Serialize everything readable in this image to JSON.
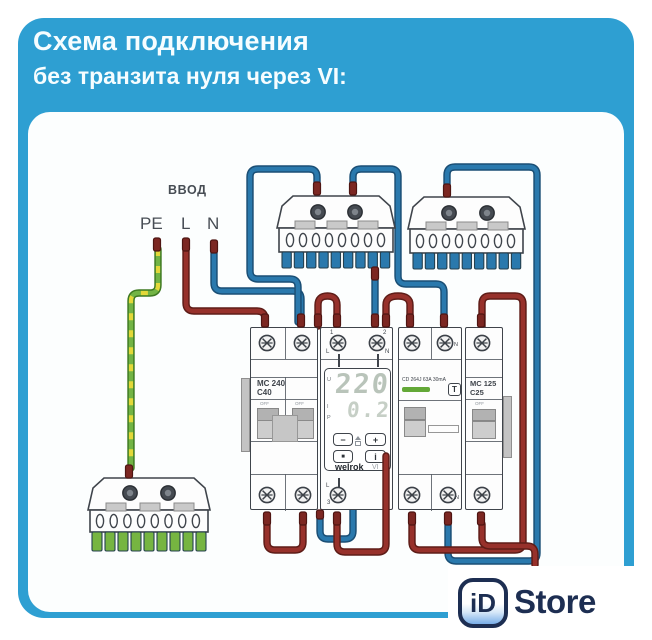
{
  "header": {
    "line1": "Схема подключения",
    "line2": "без транзита нуля через VI:"
  },
  "input": {
    "group": "ВВОД",
    "pe": "PE",
    "l": "L",
    "n": "N"
  },
  "devices": {
    "main_breaker": {
      "model": "MC 240",
      "rating": "C40",
      "off_left": "OFF",
      "off_right": "OFF"
    },
    "relay": {
      "top_term1_num": "1",
      "top_term1_letter": "L",
      "top_term2_num": "2",
      "top_term2_letter": "N",
      "mode_u": "U",
      "mode_i": "I",
      "mode_p": "P",
      "display_voltage": "220",
      "display_current": "0.2",
      "btn_minus": "−",
      "btn_plus": "+",
      "btn_set": "■",
      "btn_info": "i",
      "brand": "welrok",
      "brand_suffix": "VI",
      "bottom_letter": "L",
      "bottom_term_num": "3"
    },
    "rcd": {
      "label": "CD 264J 63A 30mA",
      "test_button": "T",
      "n_top": "N",
      "n_bottom": "N"
    },
    "load_breaker": {
      "model": "MC 125",
      "rating": "C25",
      "off": "OFF"
    }
  },
  "watermark": {
    "badge": "iD",
    "name": "Store"
  },
  "colors": {
    "card_blue": "#2e9fd2",
    "wire_live_red": "#97312b",
    "wire_neutral_blue": "#2a79ad",
    "wire_earth_green": "#72b445",
    "wire_earth_yellow": "#e3d839",
    "busbar_teeth_blue": "#2a79ad",
    "busbar_teeth_green": "#76b541",
    "logo_navy": "#1d2e52"
  }
}
